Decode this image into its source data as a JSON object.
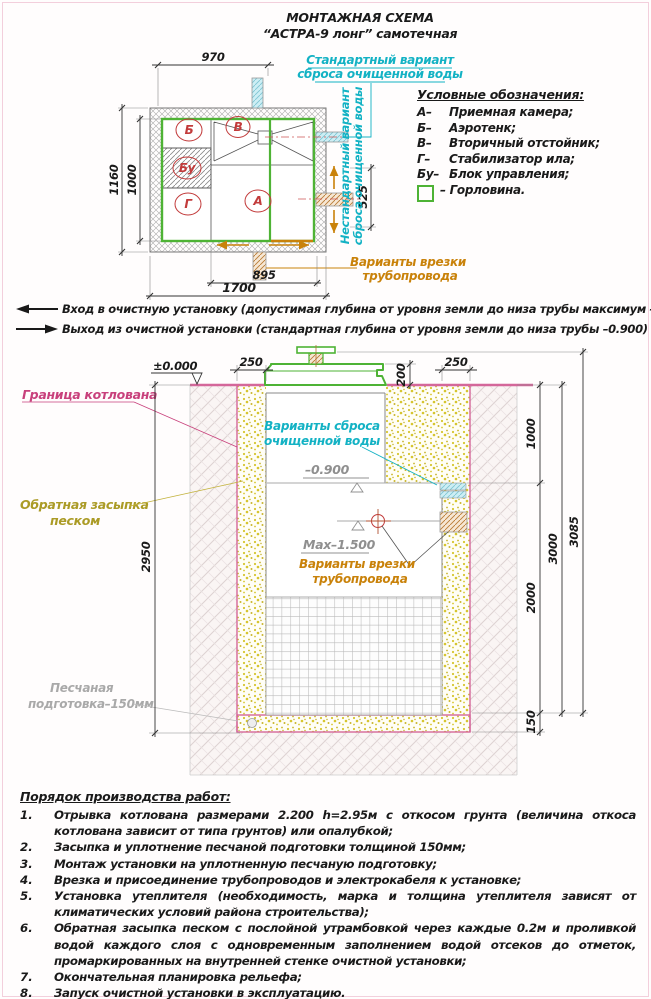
{
  "title": {
    "line1": "МОНТАЖНАЯ СХЕМА",
    "line2": "“АСТРА-9 лонг” самотечная"
  },
  "plan": {
    "dim_top": "970",
    "dim_left_outer": "1160",
    "dim_left_inner": "1000",
    "dim_right": "525",
    "dim_bottom_inner": "895",
    "dim_bottom_outer": "1700",
    "label_b": "Б",
    "label_v": "В",
    "label_bu": "Бу",
    "label_g": "Г",
    "label_a": "А",
    "callout_standard_1": "Стандартный вариант",
    "callout_standard_2": "сброса очищенной воды",
    "callout_nonstandard_1": "Нестандартный вариант",
    "callout_nonstandard_2": "сброса очищенной воды",
    "callout_tap_1": "Варианты врезки",
    "callout_tap_2": "трубопровода"
  },
  "legend": {
    "title": "Условные обозначения:",
    "items": [
      {
        "key": "А–",
        "label": "Приемная камера;"
      },
      {
        "key": "Б–",
        "label": "Аэротенк;"
      },
      {
        "key": "В–",
        "label": "Вторичный отстойник;"
      },
      {
        "key": "Г–",
        "label": "Стабилизатор ила;"
      },
      {
        "key": "Бу–",
        "label": "Блок управления;"
      },
      {
        "key": "",
        "label": "– Горловина."
      }
    ]
  },
  "io_notes": [
    {
      "dir": "in",
      "text": "Вход в очистную установку (допустимая глубина от уровня земли до низа трубы максимум –1.500)"
    },
    {
      "dir": "out",
      "text": "Выход из очистной установки (стандартная глубина от уровня земли до низа трубы –0.900)"
    }
  ],
  "section": {
    "level_zero": "±0.000",
    "level_out": "–0.900",
    "level_max": "Max–1.500",
    "dim_sand_left": "250",
    "dim_lid": "200",
    "dim_sand_right": "250",
    "dim_r1": "1000",
    "dim_r2": "2000",
    "dim_r3": "150",
    "dim_r4": "3000",
    "dim_r5": "3085",
    "dim_depth": "2950",
    "callout_pit": "Граница котлована",
    "callout_backfill_1": "Обратная засыпка",
    "callout_backfill_2": "песком",
    "callout_sandprep_1": "Песчаная",
    "callout_sandprep_2": "подготовка–150мм",
    "callout_discharge_1": "Варианты сброса",
    "callout_discharge_2": "очищенной воды",
    "callout_tap_1": "Варианты врезки",
    "callout_tap_2": "трубопровода"
  },
  "work_order": {
    "title": "Порядок производства работ:",
    "items": [
      {
        "num": "1.",
        "text": "Отрывка котлована размерами 2.200 h=2.95м с откосом грунта (величина откоса котлована зависит от типа грунтов) или опалубкой;"
      },
      {
        "num": "2.",
        "text": "Засыпка и уплотнение песчаной подготовки толщиной 150мм;"
      },
      {
        "num": "3.",
        "text": "Монтаж установки на уплотненную песчаную подготовку;"
      },
      {
        "num": "4.",
        "text": "Врезка и присоединение трубопроводов и электрокабеля к установке;"
      },
      {
        "num": "5.",
        "text": "Установка утеплителя (необходимость, марка и толщина утеплителя зависят от климатических условий района строительства);"
      },
      {
        "num": "6.",
        "text": "Обратная засыпка песком с послойной утрамбовкой через каждые 0.2м и проливкой водой каждого слоя с одновременным заполнением водой отсеков до отметок, промаркированных на внутренней стенке очистной установки;"
      },
      {
        "num": "7.",
        "text": "Окончательная планировка рельефа;"
      },
      {
        "num": "8.",
        "text": "Запуск очистной установки в эксплуатацию."
      }
    ]
  },
  "colors": {
    "green": "#4eb335",
    "cyan": "#13b2c4",
    "orange": "#c9820a",
    "pink": "#d4679a",
    "red": "#c23b3b",
    "sand": "#d6c52e"
  }
}
